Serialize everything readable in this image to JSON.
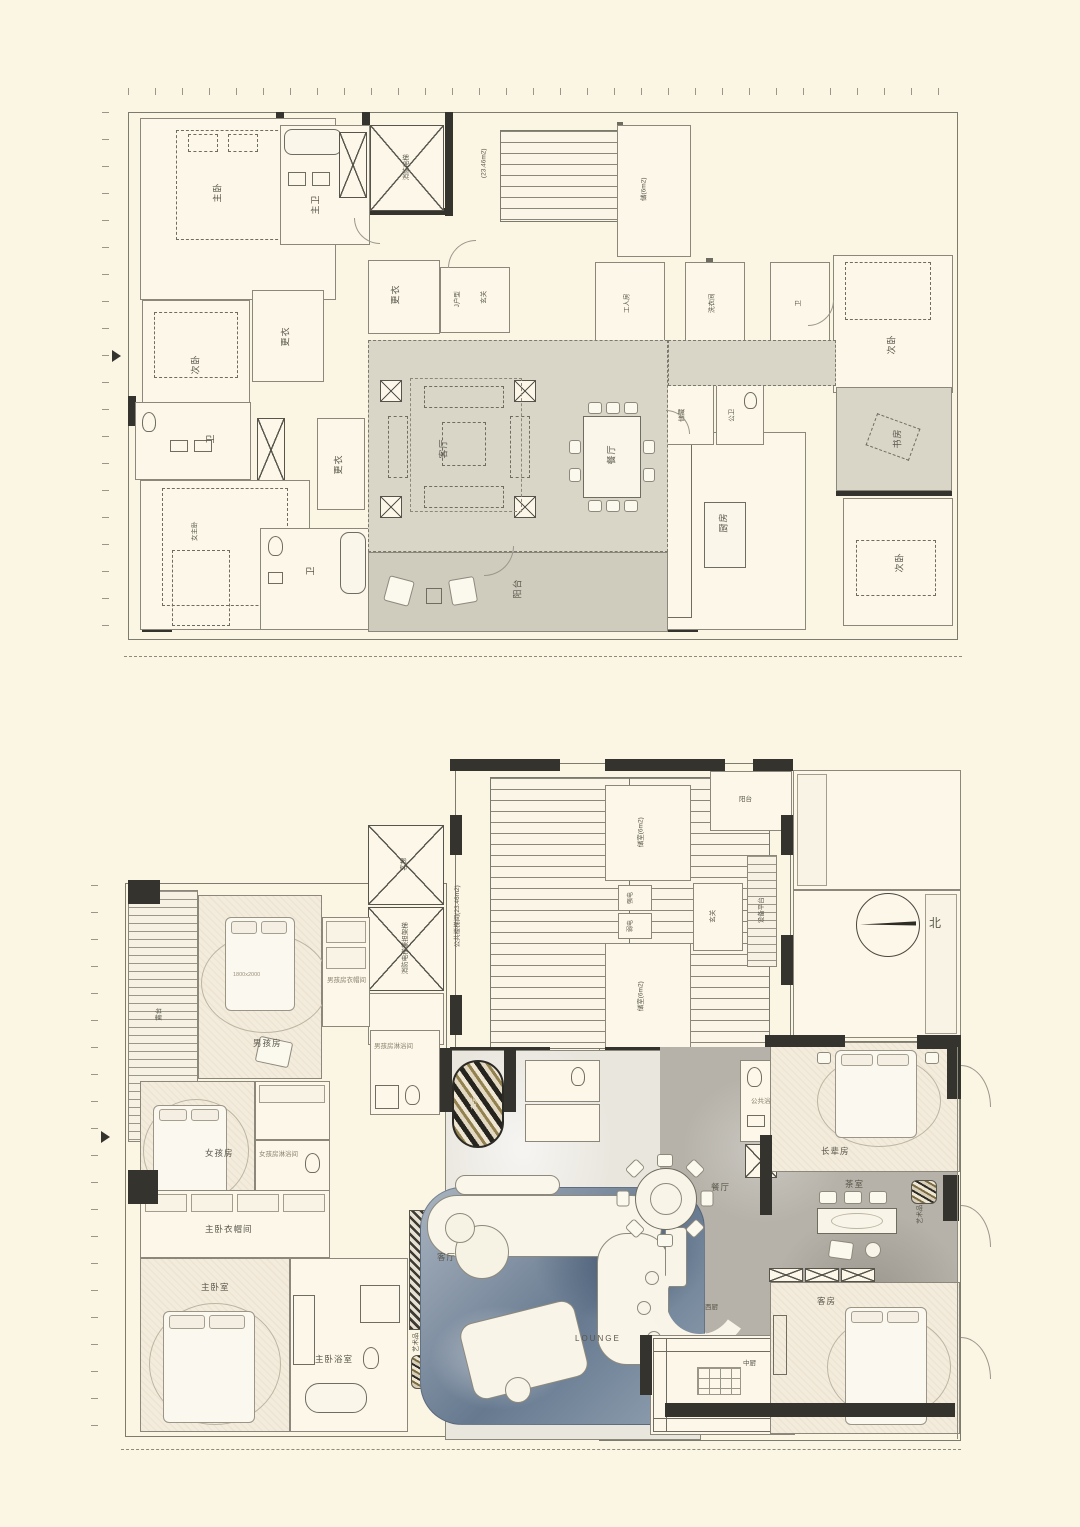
{
  "page": {
    "background": "#fbf5e4"
  },
  "compass": {
    "north": "北"
  },
  "top": {
    "rooms": {
      "master": "主卧",
      "master_bath": "主卫",
      "dress_top": "更衣",
      "second_left": "次卧",
      "dress_mid": "更衣",
      "bath_mid": "卫",
      "dress_low": "更衣",
      "female_master": "女主卧",
      "bath_low": "卫",
      "foyer": "玄关",
      "unit": "J户型",
      "living": "客厅",
      "dining": "餐厅",
      "balcony": "阳台",
      "kitchen": "厨房",
      "storage": "储藏",
      "public_bath": "公卫",
      "staff": "工人房",
      "laundry": "洗衣间",
      "store6": "储(6m2)",
      "second_tr": "次卧",
      "bath_tr": "卫",
      "study": "书房",
      "second_br": "次卧"
    },
    "ann": {
      "stair": "(23.46m2)",
      "lift": "消防电梯"
    }
  },
  "bottom": {
    "rooms": {
      "terrace": "露台",
      "boy": "男孩房",
      "boy_closet": "男孩房衣帽间",
      "boy_bath": "男孩房淋浴间",
      "girl": "女孩房",
      "girl_bath": "女孩房淋浴间",
      "master_closet": "主卧衣帽间",
      "master": "主卧室",
      "master_bath": "主卧浴室",
      "foyer": "玄关",
      "living": "客厅",
      "lounge": "LOUNGE",
      "dining": "餐厅",
      "west_kitchen": "西厨",
      "chinese_kitchen": "中厨",
      "tea": "茶室",
      "elder": "长辈房",
      "guest": "客房",
      "public_bath": "公共浴室",
      "store_a": "储室(6m2)",
      "store_b": "储室(6m2)",
      "core_foyer": "玄关",
      "equipment": "设备平台",
      "balcony_a": "阳台"
    },
    "ann": {
      "stair": "公共楼梯间(23.46m2)",
      "lift_a": "客梯",
      "lift_b": "消防电梯兼担架梯",
      "strong": "强电",
      "weak": "弱电",
      "art_a": "艺术品",
      "art_b": "艺术品",
      "bed_size": "1800x2000"
    }
  }
}
